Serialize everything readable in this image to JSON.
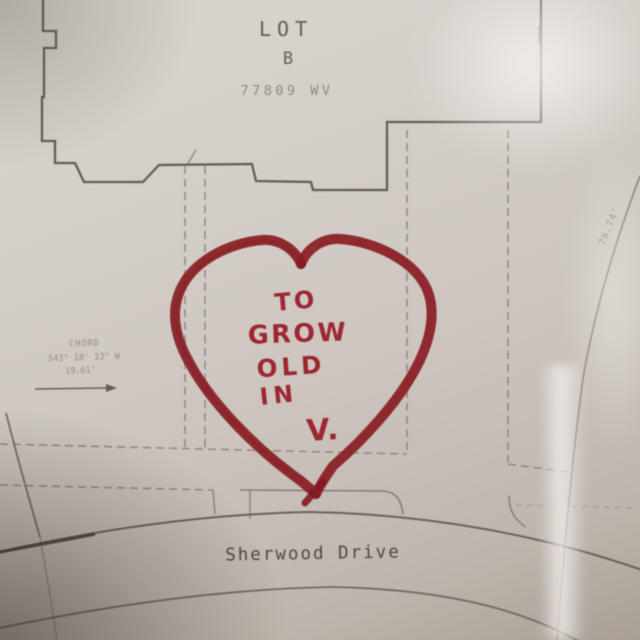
{
  "colors": {
    "paper": "#d0c9c3",
    "plot_ink": "#57504b",
    "faint_ink": "#8f867d",
    "marker_red": "#8a1e24",
    "marker_text_red": "#9d2530"
  },
  "plan": {
    "lot_label": "LOT",
    "lot_letter": "B",
    "lot_area": "77809 WV",
    "chord_label": "CHORD",
    "chord_bearing": "S43° 18' 23\" W",
    "chord_length": "19.61'",
    "side_dimension": "76.74'",
    "street_name": "Sherwood Drive"
  },
  "heart": {
    "message": "TO GROW OLD IN V.",
    "line1": "TO",
    "line2": "GROW",
    "line3": "OLD",
    "line4": "IN",
    "line5": "V."
  }
}
